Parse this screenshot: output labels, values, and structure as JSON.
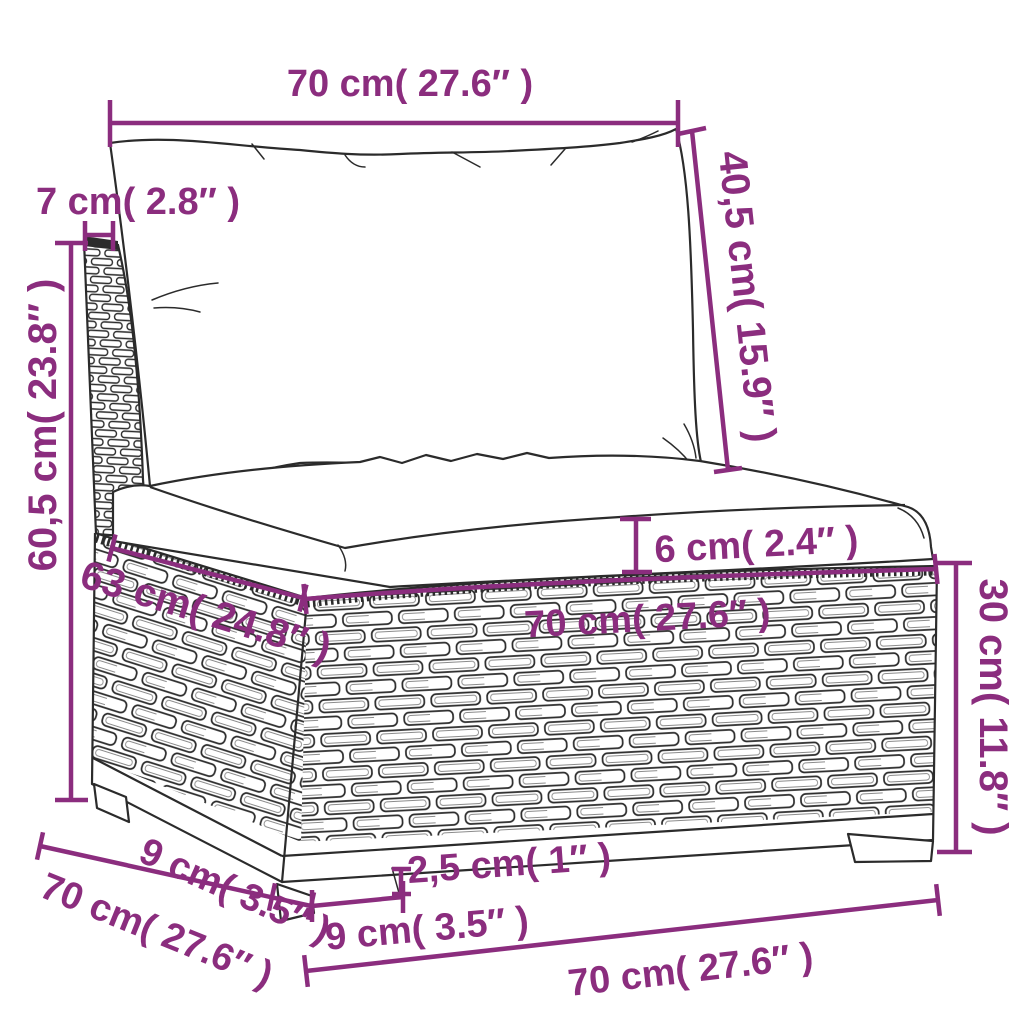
{
  "colors": {
    "dimension": "#8b2d7e",
    "line_art": "#2b2b2b",
    "background": "#ffffff"
  },
  "dimensions": {
    "back_cushion_width": {
      "label": "70 cm( 27.6″ )"
    },
    "back_cushion_height": {
      "label": "40,5 cm( 15.9″ )"
    },
    "back_frame_depth": {
      "label": "7 cm( 2.8″ )"
    },
    "total_height": {
      "label": "60,5 cm( 23.8″ )"
    },
    "seat_cushion_thickness": {
      "label": "6 cm( 2.4″ )"
    },
    "seat_depth": {
      "label": "63 cm( 24.8″ )"
    },
    "seat_width": {
      "label": "70 cm( 27.6″ )"
    },
    "base_height": {
      "label": "30 cm( 11.8″ )"
    },
    "leg_side_width": {
      "label": "9 cm( 3.5″ )"
    },
    "side_depth": {
      "label": "70 cm( 27.6″ )"
    },
    "leg_height": {
      "label": "2,5 cm( 1″ )"
    },
    "leg_front_width": {
      "label": "9 cm( 3.5″ )"
    },
    "base_width": {
      "label": "70 cm( 27.6″ )"
    }
  }
}
